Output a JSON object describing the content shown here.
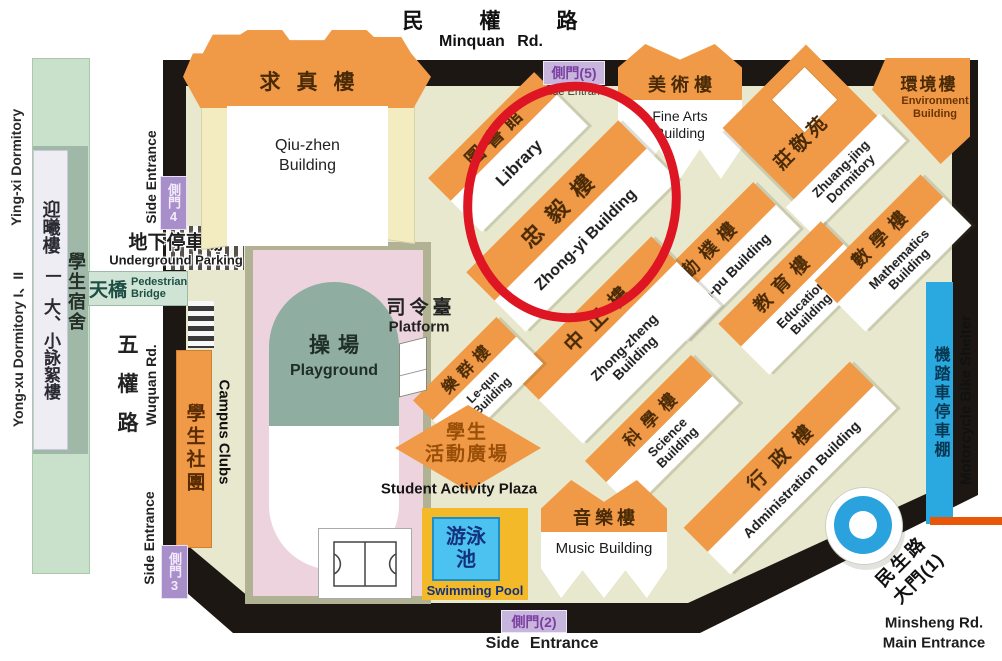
{
  "roads": {
    "minquan": {
      "zh": "民權路",
      "en": "Minquan Rd."
    },
    "wuquan": {
      "zh": "五權路",
      "en": "Wuquan Rd."
    },
    "minsheng": {
      "zh1": "民生路",
      "zh2": "大門(1)",
      "en1": "Minsheng Rd.",
      "en2": "Main Entrance"
    }
  },
  "gates": {
    "gate5": "側門(5)",
    "gate4": "側門4",
    "gate3": "側門3",
    "gate2": "側門(2)",
    "side_entrance": "Side Entrance"
  },
  "dormitories": {
    "yingxi_en": "Ying-xi Dormitory",
    "yongxu_en": "Yong-xu Dormitory I、II",
    "yingxi_zh": "迎曦樓",
    "divider_zh": "一",
    "yongxu_zh": "大、小詠絮樓",
    "student_dorm_zh": "學生宿舍",
    "zhuangjing": {
      "zh": "莊敬苑",
      "en": "Zhuang-jing Dormitory"
    }
  },
  "buildings": {
    "qiuzhen": {
      "zh": "求真樓",
      "en": "Qiu-zhen Building"
    },
    "library": {
      "zh": "圖書館",
      "en": "Library"
    },
    "zhongyi": {
      "zh": "忠毅樓",
      "en": "Zhong-yi Building"
    },
    "finearts": {
      "zh": "美術樓",
      "en": "Fine Arts Building"
    },
    "environment": {
      "zh": "環境樓",
      "en": "Environment Building"
    },
    "qinpu": {
      "zh": "勤樸樓",
      "en": "Qin-pu Building"
    },
    "education": {
      "zh": "教育樓",
      "en": "Education Building"
    },
    "mathematics": {
      "zh": "數學樓",
      "en": "Mathematics Building"
    },
    "zhongzheng": {
      "zh": "中正樓",
      "en": "Zhong-zheng Building"
    },
    "lequn": {
      "zh": "樂群樓",
      "en": "Le-qun Building"
    },
    "science": {
      "zh": "科學樓",
      "en": "Science Building"
    },
    "administration": {
      "zh": "行政樓",
      "en": "Administration Building"
    },
    "music": {
      "zh": "音樂樓",
      "en": "Music Building"
    }
  },
  "facilities": {
    "platform": {
      "zh": "司令臺",
      "en": "Platform"
    },
    "playground": {
      "zh": "操場",
      "en": "Playground"
    },
    "plaza": {
      "zh1": "學生",
      "zh2": "活動廣場",
      "en": "Student Activity Plaza"
    },
    "pool": {
      "zh": "游泳池",
      "en": "Swimming Pool"
    },
    "clubs": {
      "zh": "學生社團",
      "en": "Campus Clubs"
    },
    "bridge": {
      "zh": "天橋",
      "en": "Pedestrian Bridge"
    },
    "parking": {
      "zh": "地下停車場",
      "en": "Underground Parking"
    },
    "shelter": {
      "zh": "機踏車停車棚",
      "en": "Motorcycle Bike Shelter"
    }
  },
  "colors": {
    "roof_orange": "#F09A47",
    "ground_beige": "#E8E8CE",
    "border_black": "#1C1712",
    "highlight_red": "#DE1523",
    "gate_badge_purple": "#A98FC9",
    "pool_blue": "#4CC2F1",
    "pool_deck_yellow": "#F3B929",
    "bike_shelter_blue": "#2AA9E1",
    "main_entrance_line_orange": "#E85708",
    "dorm_green": "#C9E0CB",
    "playground_pink": "#EDD3DE",
    "field_teal": "#8FADA0"
  }
}
